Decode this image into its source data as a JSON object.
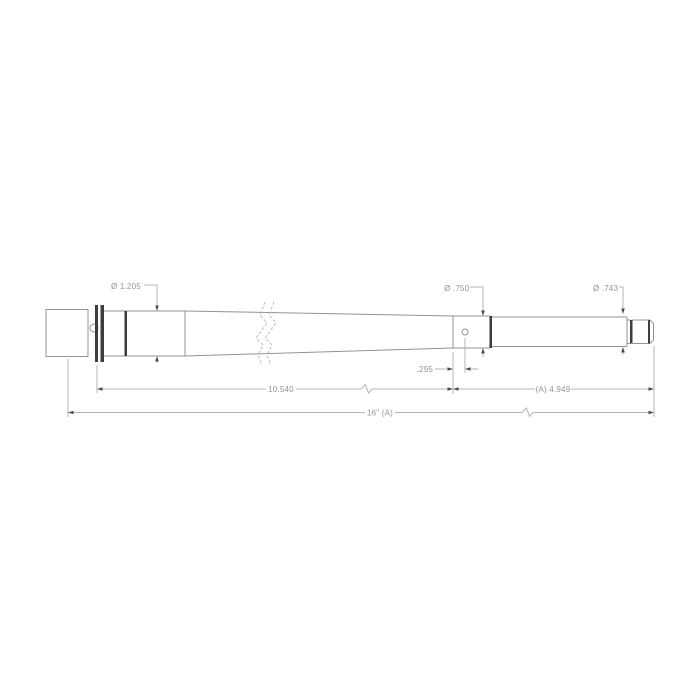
{
  "drawing": {
    "type": "engineering-dimension-drawing",
    "subject": "barrel-side-profile",
    "labels": {
      "chamber_diameter": "Ø 1.205",
      "gas_journal_diameter": "Ø .750",
      "muzzle_diameter": "Ø .743",
      "gas_port_offset": ".295",
      "breech_to_gas_length": "10.540",
      "gas_to_muzzle_length": "(A) 4.949",
      "overall_length": "16\" (A)"
    },
    "colors": {
      "background": "#ffffff",
      "line_light": "#939393",
      "line_break": "#bcbcbc",
      "line_dark": "#3d3d3d",
      "dim_line": "#b4b4b4",
      "arrow": "#4a4a4a",
      "text": "#949494"
    }
  }
}
